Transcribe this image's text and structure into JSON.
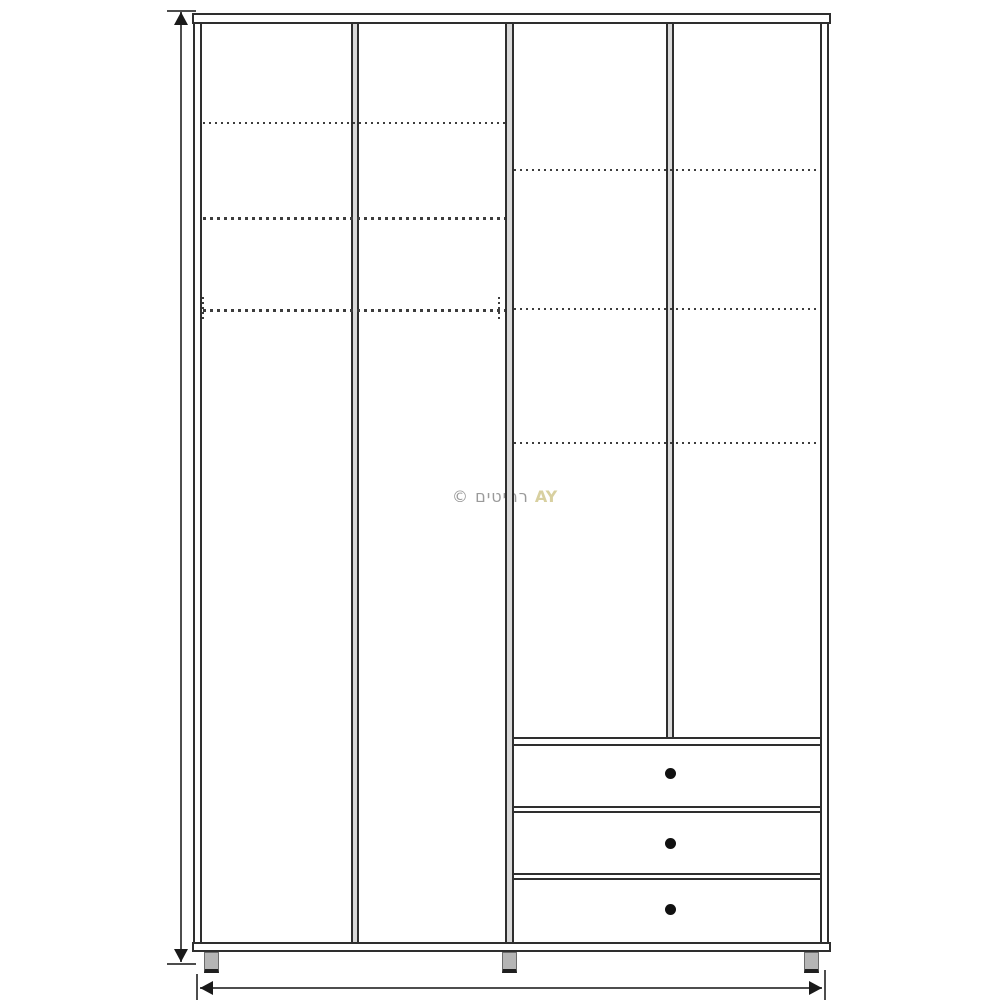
{
  "page": {
    "background": "#ffffff"
  },
  "watermark": {
    "copyright_symbol": "©",
    "brand_hebrew": " רהיטים",
    "brand_latin": "AY",
    "color_gray": "#9a9a9a",
    "color_gold": "#d8d0a0"
  },
  "diagram": {
    "subject": "wardrobe-front-elevation-drawing",
    "door_sections": 4,
    "drawer_count": 3,
    "knob_count": 3,
    "feet_count": 3,
    "dashed_shelf_lines_left_half": 3,
    "dashed_shelf_lines_right_half": 3,
    "line_color": "#2e2e2e",
    "divider_fill_color": "#d9d9d9",
    "foot_fill_color": "#b5b5b5",
    "dimension_line_color": "#4d4d4d",
    "dimension_labels_visible": false
  }
}
